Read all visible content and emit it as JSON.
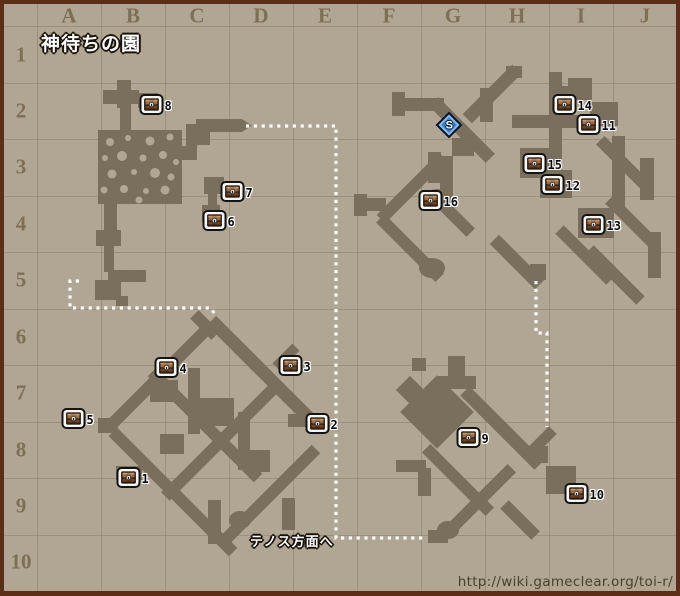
{
  "title": "神待ちの園",
  "grid": {
    "columns": [
      "A",
      "B",
      "C",
      "D",
      "E",
      "F",
      "G",
      "H",
      "I",
      "J"
    ],
    "rows": [
      "1",
      "2",
      "3",
      "4",
      "5",
      "6",
      "7",
      "8",
      "9",
      "10"
    ]
  },
  "markers": {
    "chests": [
      {
        "id": "1",
        "x": 128,
        "y": 477
      },
      {
        "id": "2",
        "x": 317,
        "y": 423
      },
      {
        "id": "3",
        "x": 290,
        "y": 365
      },
      {
        "id": "4",
        "x": 166,
        "y": 367
      },
      {
        "id": "5",
        "x": 73,
        "y": 418
      },
      {
        "id": "6",
        "x": 214,
        "y": 220
      },
      {
        "id": "7",
        "x": 232,
        "y": 191
      },
      {
        "id": "8",
        "x": 151,
        "y": 104
      },
      {
        "id": "9",
        "x": 468,
        "y": 437
      },
      {
        "id": "10",
        "x": 576,
        "y": 493
      },
      {
        "id": "11",
        "x": 588,
        "y": 124
      },
      {
        "id": "12",
        "x": 552,
        "y": 184
      },
      {
        "id": "13",
        "x": 593,
        "y": 224
      },
      {
        "id": "14",
        "x": 564,
        "y": 104
      },
      {
        "id": "15",
        "x": 534,
        "y": 163
      },
      {
        "id": "16",
        "x": 430,
        "y": 200
      }
    ],
    "start": {
      "label": "S",
      "x": 449,
      "y": 125
    }
  },
  "annotations": {
    "exit_label": "テノス方面へ",
    "source_url": "http://wiki.gameclear.org/toi-r/"
  },
  "colors": {
    "frame": "#5c2e18",
    "background": "#b2a795",
    "grid_line": "#8a7f68",
    "dungeon": "#7a6e5d",
    "header_text": "#7e7057",
    "route_dots": "#ffffff",
    "start_blue": "#2e7fd6",
    "url_text": "#4c3f2d"
  }
}
